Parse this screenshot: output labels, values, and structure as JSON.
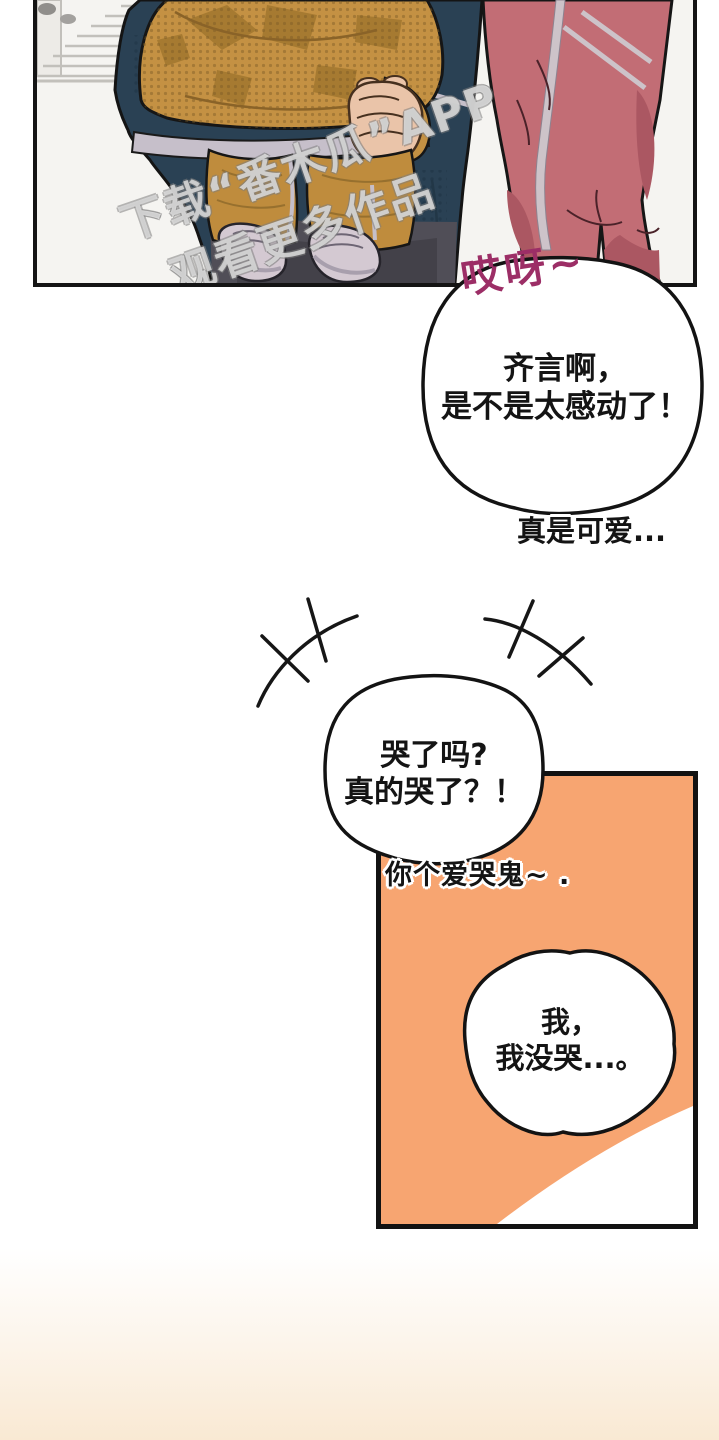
{
  "colors": {
    "paper": "#ffffff",
    "ink": "#141414",
    "panelBg": "#f5f4f1",
    "stairLine": "#c2c0bb",
    "stairFill": "#edebe7",
    "jacket": "#2a4154",
    "jacketDark": "#223747",
    "trimLight": "#c6bfca",
    "hoodie": "#c49143",
    "hoodiePatch": "#a67a31",
    "hoodieDot": "#7c5c25",
    "pantsChild": "#bf8c3d",
    "pantsChildShade": "#97702e",
    "shoe": "#d4c9d2",
    "shoeShade": "#a89fad",
    "pantsAdult": "#504e57",
    "skin": "#eac4a9",
    "pink": "#c26d75",
    "pinkShade": "#ab5762",
    "pinkStripe": "#cdc3c9",
    "orange": "#f7a571",
    "magenta": "#9c2e66",
    "peach": "#f9e9d3"
  },
  "watermark": {
    "line1": "下载“番木瓜”APP",
    "line2": "观看更多作品"
  },
  "sfx": {
    "text": "哎呀~"
  },
  "bubble1": {
    "line1": "齐言啊，",
    "line2": "是不是太感动了！"
  },
  "caption1": {
    "text": "真是可爱..."
  },
  "bubble2": {
    "line1": "哭了吗?",
    "line2": "真的哭了？！"
  },
  "caption2": {
    "text": "你个爱哭鬼~ ."
  },
  "bubble3": {
    "line1": "我，",
    "line2": "我没哭...。"
  }
}
